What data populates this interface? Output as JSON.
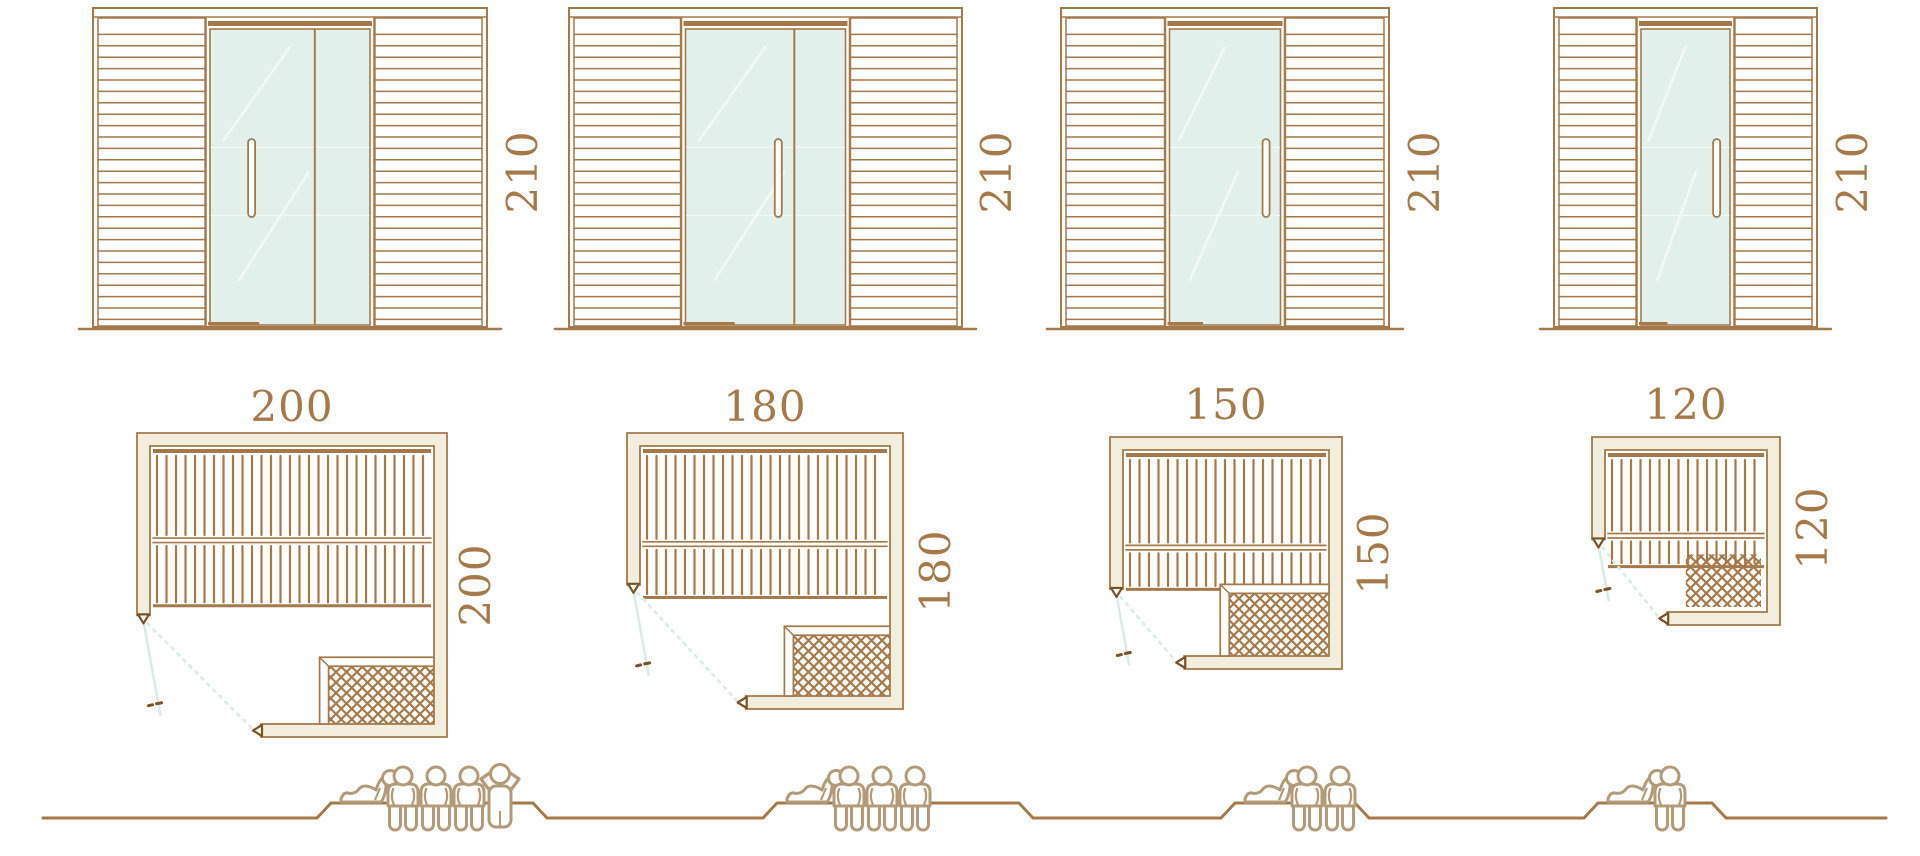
{
  "diagram": {
    "type": "sauna-size-comparison",
    "unit": "cm",
    "views": [
      "front-elevation",
      "floor-plan",
      "capacity-figures"
    ]
  },
  "colors": {
    "wood_line": "#a5794a",
    "dark_accent": "#7a5226",
    "dimension_text": "#a5794a",
    "glass_fill": "#e3f1ed",
    "glass_reflection": "#f2f9f6",
    "wall_fill": "#f2eddc",
    "door_swing": "#d9ece5",
    "people_line": "#b39b79",
    "background": "#ffffff"
  },
  "units": [
    {
      "id": "size-200",
      "elevation": {
        "height_label": "210",
        "door_panes": 2
      },
      "plan": {
        "width_label": "200",
        "depth_label": "200",
        "bench_rows": 2,
        "heater_guard": true
      },
      "capacity": {
        "lying": 1,
        "seated": 3,
        "standing": 1
      }
    },
    {
      "id": "size-180",
      "elevation": {
        "height_label": "210",
        "door_panes": 2
      },
      "plan": {
        "width_label": "180",
        "depth_label": "180",
        "bench_rows": 2,
        "heater_guard": true
      },
      "capacity": {
        "lying": 1,
        "seated": 3,
        "standing": 0
      }
    },
    {
      "id": "size-150",
      "elevation": {
        "height_label": "210",
        "door_panes": 1
      },
      "plan": {
        "width_label": "150",
        "depth_label": "150",
        "bench_rows": 2,
        "heater_guard": true
      },
      "capacity": {
        "lying": 1,
        "seated": 2,
        "standing": 0
      }
    },
    {
      "id": "size-120",
      "elevation": {
        "height_label": "210",
        "door_panes": 1
      },
      "plan": {
        "width_label": "120",
        "depth_label": "120",
        "bench_rows": 2,
        "heater_guard": false
      },
      "capacity": {
        "lying": 1,
        "seated": 1,
        "standing": 0
      }
    }
  ]
}
